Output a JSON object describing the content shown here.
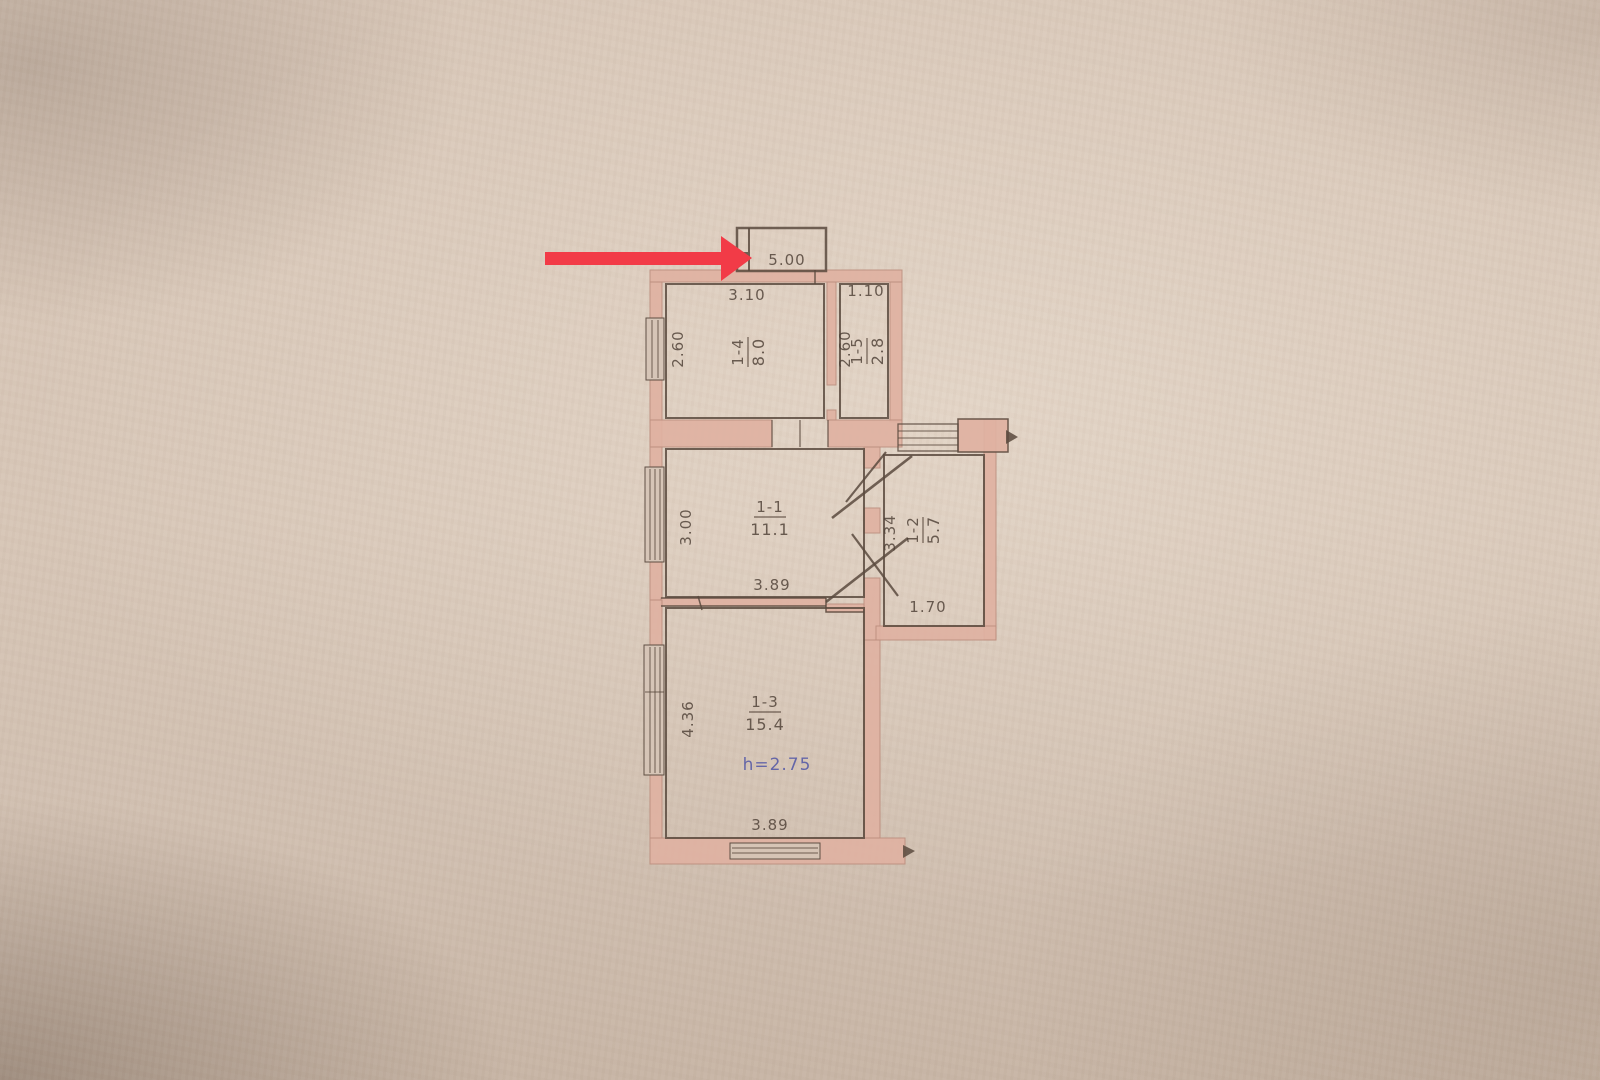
{
  "photo": {
    "paper_color": "#d6c5b7",
    "ink_color": "#5a4a3e",
    "text_ink_color": "#4e4036",
    "wall_fill_color": "#e0b2a2",
    "wall_stroke_color": "#bd8f7f",
    "arrow_color": "#f23b47",
    "note_color": "#5156a6"
  },
  "plan": {
    "balcony": {
      "dim_width": "5.00"
    },
    "rooms": {
      "r14": {
        "id": "1-4",
        "area": "8.0",
        "dim_width": "3.10",
        "dim_depth": "2.60"
      },
      "r15": {
        "id": "1-5",
        "area": "2.8",
        "dim_width": "1.10",
        "dim_depth": "2.60"
      },
      "r11": {
        "id": "1-1",
        "area": "11.1",
        "dim_width": "3.89",
        "dim_depth": "3.00"
      },
      "r12": {
        "id": "1-2",
        "area": "5.7",
        "dim_width": "1.70",
        "dim_depth": "3.34"
      },
      "r13": {
        "id": "1-3",
        "area": "15.4",
        "dim_width": "3.89",
        "dim_depth": "4.36",
        "height_note": "h=2.75"
      }
    }
  }
}
